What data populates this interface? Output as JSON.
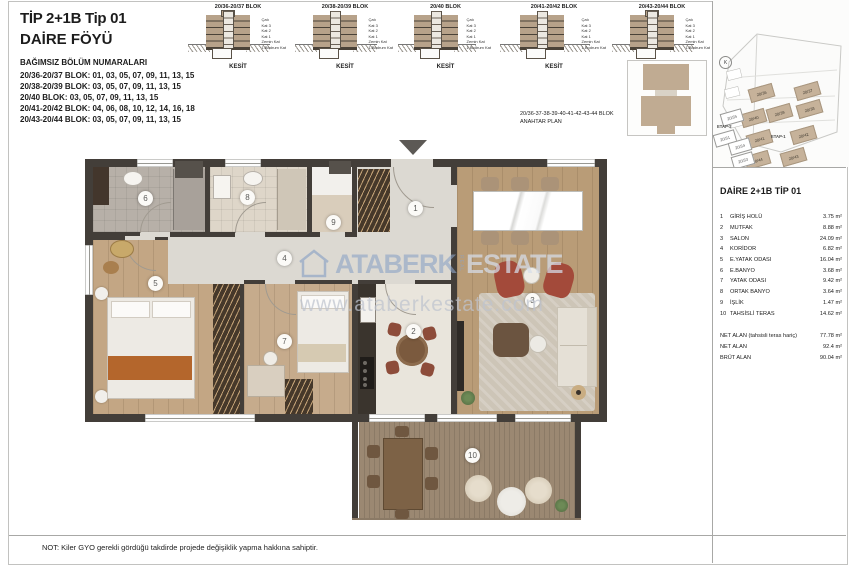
{
  "page": {
    "title1": "TİP 2+1B Tip 01",
    "title2": "DAİRE FÖYÜ",
    "note": "NOT: Kiler GYO gerekli gördüğü takdirde projede değişiklik yapma hakkına sahiptir."
  },
  "unit_info": {
    "heading": "BAĞIMSIZ BÖLÜM NUMARALARI",
    "lines": [
      "20/36-20/37 BLOK: 01, 03, 05, 07, 09, 11, 13, 15",
      "20/38-20/39 BLOK: 03, 05, 07, 09, 11, 13, 15",
      "20/40 BLOK: 03, 05, 07, 09, 11, 13, 15",
      "20/41-20/42 BLOK: 04, 06, 08, 10, 12, 14, 16, 18",
      "20/43-20/44 BLOK: 03, 05, 07, 09, 11, 13, 15"
    ]
  },
  "sections": {
    "floor_labels": "Çatı\nKat 3\nKat 2\nKat 1\nZemin Kat\n1.Bodrum Kat",
    "items": [
      {
        "title": "20/36-20/37 BLOK",
        "caption": "KESİT"
      },
      {
        "title": "20/38-20/39 BLOK",
        "caption": "KESİT"
      },
      {
        "title": "20/40 BLOK",
        "caption": "KESİT"
      },
      {
        "title": "20/41-20/42 BLOK",
        "caption": "KESİT"
      },
      {
        "title": "20/43-20/44 BLOK",
        "caption": "KESİT"
      }
    ]
  },
  "key_plan": {
    "line1": "20/36-37-38-39-40-41-42-43-44 BLOK",
    "line2": "ANAHTAR PLAN"
  },
  "site_map": {
    "compass": "K",
    "etap1": "ETAP-1",
    "etap2": "ETAP-2",
    "filled": [
      "20/36",
      "20/37",
      "20/40",
      "20/39",
      "20/38",
      "20/41",
      "20/42",
      "20/44",
      "20/43"
    ],
    "outline": [
      "20/35",
      "20/31",
      "20/34",
      "20/33"
    ]
  },
  "panel": {
    "title": "DAİRE 2+1B TİP 01",
    "rooms": [
      {
        "no": "1",
        "name": "GİRİŞ HOLÜ",
        "area": "3.75 m²"
      },
      {
        "no": "2",
        "name": "MUTFAK",
        "area": "8.88 m²"
      },
      {
        "no": "3",
        "name": "SALON",
        "area": "24.09 m²"
      },
      {
        "no": "4",
        "name": "KORİDOR",
        "area": "6.82 m²"
      },
      {
        "no": "5",
        "name": "E.YATAK ODASI",
        "area": "16.04 m²"
      },
      {
        "no": "6",
        "name": "E.BANYO",
        "area": "3.68 m²"
      },
      {
        "no": "7",
        "name": "YATAK ODASI",
        "area": "9.42 m²"
      },
      {
        "no": "8",
        "name": "ORTAK BANYO",
        "area": "3.64 m²"
      },
      {
        "no": "9",
        "name": "İŞLİK",
        "area": "1.47 m²"
      },
      {
        "no": "10",
        "name": "TAHSİSLİ TERAS",
        "area": "14.62 m²"
      }
    ],
    "summary": [
      {
        "label": "NET ALAN (tahsisli teras hariç)",
        "value": "77.78 m²"
      },
      {
        "label": "NET ALAN",
        "value": "92.4 m²"
      },
      {
        "label": "BRÜT ALAN",
        "value": "90.04 m²"
      }
    ]
  },
  "plan": {
    "badges": [
      "1",
      "2",
      "3",
      "4",
      "5",
      "6",
      "7",
      "8",
      "9",
      "10"
    ],
    "watermark": {
      "brand_left": "ATABERK",
      "brand_mid": "REAL",
      "brand_right": "ESTATE",
      "url": "www.ataberkestate.com"
    }
  },
  "palette": {
    "wall": "#433e39",
    "bedroom_wood": "#c3a684",
    "salon_wood": "#b99c77",
    "corridor_tile": "#dcd9d2",
    "terrace_deck": "#9b8872",
    "building_tan": "#b7a28a",
    "site_block_tan": "#c6b29a",
    "watermark_blue": "#8ca3c5",
    "armchair_rust": "#a34a3a",
    "bed_runner_orange": "#b4662c"
  }
}
